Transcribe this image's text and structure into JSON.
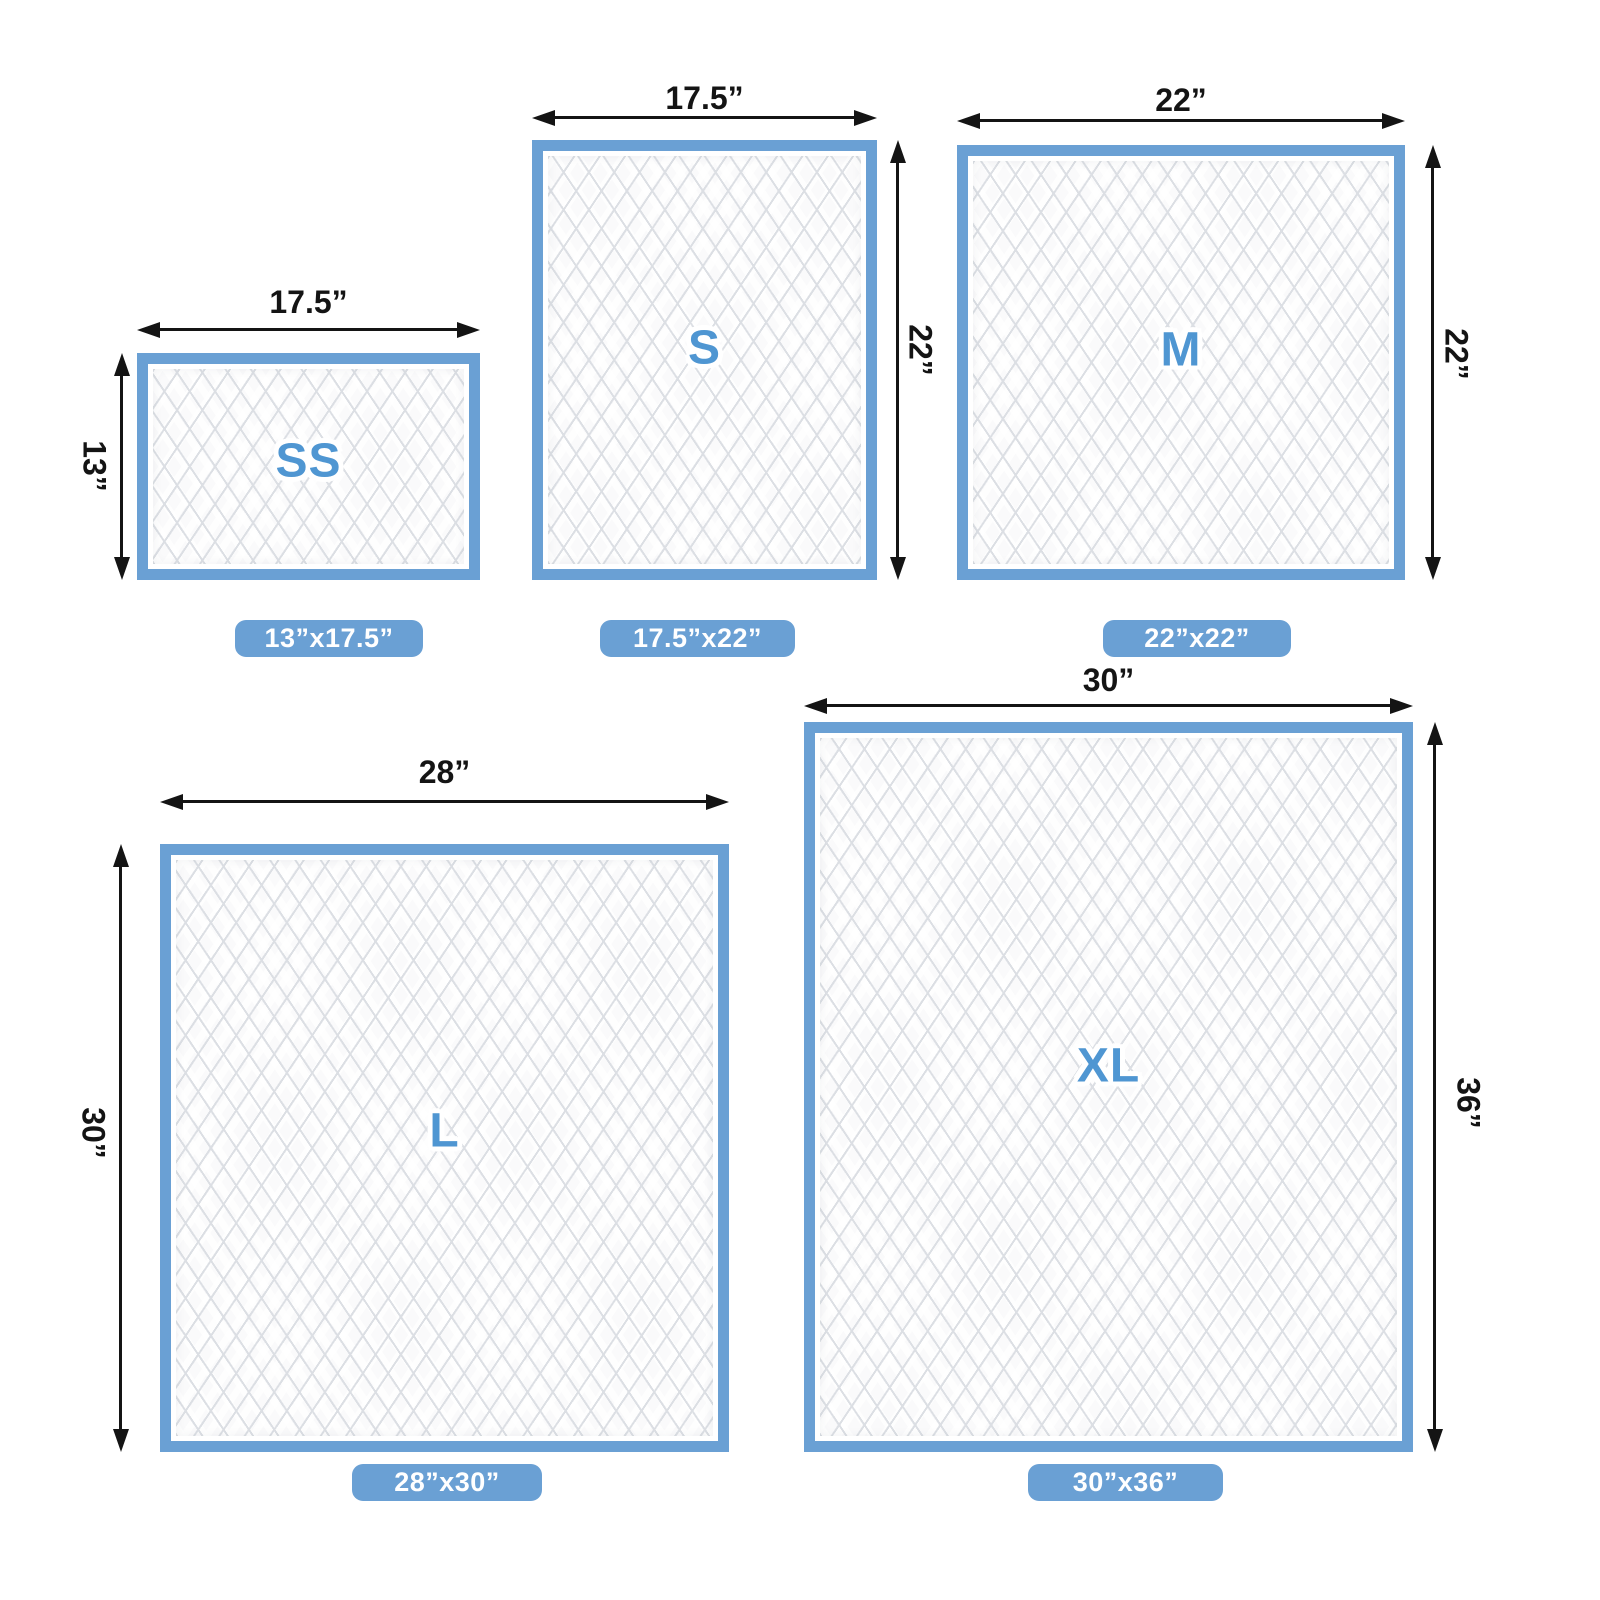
{
  "colors": {
    "pad_border_blue": "#6AA0D4",
    "badge_blue": "#6AA0D4",
    "letter_blue": "#4F96D2",
    "arrow_black": "#141414",
    "quilt_line": "#dcdfe4",
    "background": "#ffffff"
  },
  "pads": [
    {
      "id": "ss",
      "letter": "SS",
      "top_dim": "17.5”",
      "side_dim": "13”",
      "side_dim_position": "left",
      "badge": "13”x17.5”"
    },
    {
      "id": "s",
      "letter": "S",
      "top_dim": "17.5”",
      "side_dim": "22”",
      "side_dim_position": "right",
      "badge": "17.5”x22”"
    },
    {
      "id": "m",
      "letter": "M",
      "top_dim": "22”",
      "side_dim": "22”",
      "side_dim_position": "right",
      "badge": "22”x22”"
    },
    {
      "id": "l",
      "letter": "L",
      "top_dim": "28”",
      "side_dim": "30”",
      "side_dim_position": "left",
      "badge": "28”x30”"
    },
    {
      "id": "xl",
      "letter": "XL",
      "top_dim": "30”",
      "side_dim": "36”",
      "side_dim_position": "right",
      "badge": "30”x36”"
    }
  ]
}
